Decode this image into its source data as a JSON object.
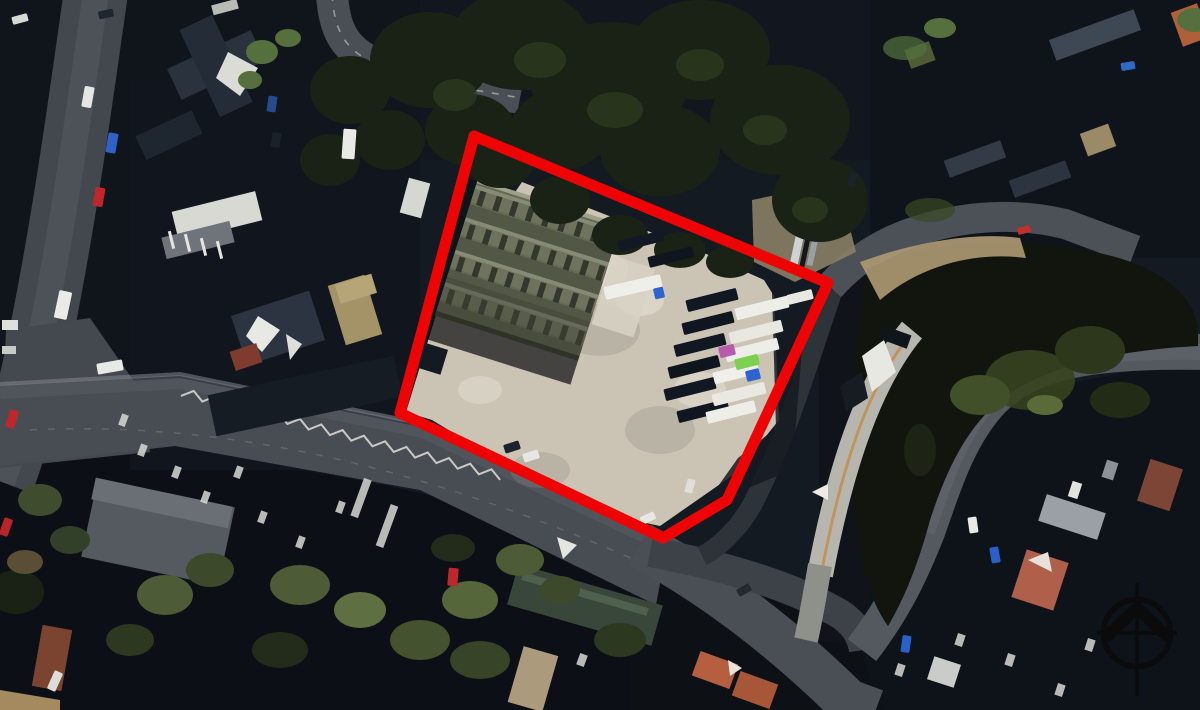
{
  "scene": {
    "description": "aerial-photograph of an industrial yard with warehouse and trailer park, red site boundary overlay, north compass icon"
  },
  "palette": {
    "boundary_red": "#ee0404",
    "compass_black": "#0b0b0b",
    "base_dark": "#141a21",
    "roof_dark": "#10151c",
    "road_grey": "#484d54",
    "concrete_light": "#cbc4b5",
    "warehouse_roof": "#666a56",
    "tree_dark": "#1a2215",
    "tree_olive": "#4e5c36",
    "water_dark": "#11150e",
    "earth_tan": "#ab9872",
    "terracotta": "#b65f40",
    "truck_white": "#eeeee8",
    "truck_dark": "#121822",
    "truck_magenta": "#b85aae",
    "truck_green": "#7cd24f",
    "truck_blue": "#2f63cf"
  },
  "site_boundary": {
    "color": "#ee0404",
    "stroke_width": 11,
    "points": "474,136 828,283 727,500 663,538 400,413"
  },
  "compass": {
    "transform": "translate(1137,633)",
    "color": "#0b0b0b"
  },
  "road_markings": {
    "zigzag": {
      "x1": 182,
      "y1": 392,
      "x2": 505,
      "y2": 477,
      "amplitude": 4,
      "step": 11
    }
  },
  "trailers": [
    {
      "x": 712,
      "y": 300,
      "w": 52,
      "h": 12,
      "rot": -14,
      "color": "#121822"
    },
    {
      "x": 708,
      "y": 323,
      "w": 52,
      "h": 12,
      "rot": -14,
      "color": "#10161f"
    },
    {
      "x": 700,
      "y": 345,
      "w": 52,
      "h": 12,
      "rot": -14,
      "color": "#121822"
    },
    {
      "x": 694,
      "y": 367,
      "w": 52,
      "h": 12,
      "rot": -14,
      "color": "#0f151d"
    },
    {
      "x": 690,
      "y": 389,
      "w": 52,
      "h": 12,
      "rot": -14,
      "color": "#121822"
    },
    {
      "x": 703,
      "y": 411,
      "w": 52,
      "h": 12,
      "rot": -14,
      "color": "#10161f"
    },
    {
      "x": 641,
      "y": 241,
      "w": 46,
      "h": 11,
      "rot": -14,
      "color": "#131924"
    },
    {
      "x": 671,
      "y": 257,
      "w": 46,
      "h": 11,
      "rot": -14,
      "color": "#101620"
    },
    {
      "x": 762,
      "y": 308,
      "w": 54,
      "h": 12,
      "rot": -14,
      "color": "#eeeee8"
    },
    {
      "x": 756,
      "y": 332,
      "w": 54,
      "h": 12,
      "rot": -14,
      "color": "#e8e7e0"
    },
    {
      "x": 752,
      "y": 350,
      "w": 54,
      "h": 12,
      "rot": -14,
      "color": "#eeeee8"
    },
    {
      "x": 736,
      "y": 373,
      "w": 46,
      "h": 12,
      "rot": -14,
      "color": "#f0efe9"
    },
    {
      "x": 739,
      "y": 394,
      "w": 54,
      "h": 12,
      "rot": -14,
      "color": "#e9e8e1"
    },
    {
      "x": 731,
      "y": 412,
      "w": 50,
      "h": 12,
      "rot": -14,
      "color": "#eeeee8"
    },
    {
      "x": 800,
      "y": 297,
      "w": 26,
      "h": 10,
      "rot": -14,
      "color": "#e9e9e3"
    },
    {
      "x": 727,
      "y": 351,
      "w": 16,
      "h": 11,
      "rot": -14,
      "color": "#b85aae"
    },
    {
      "x": 747,
      "y": 362,
      "w": 24,
      "h": 11,
      "rot": -14,
      "color": "#7cd24f"
    },
    {
      "x": 753,
      "y": 375,
      "w": 14,
      "h": 11,
      "rot": -14,
      "color": "#2f63cf"
    },
    {
      "x": 633,
      "y": 287,
      "w": 58,
      "h": 13,
      "rot": -13,
      "color": "#efefe9"
    },
    {
      "x": 659,
      "y": 293,
      "w": 10,
      "h": 11,
      "rot": -13,
      "color": "#2f63cf"
    }
  ],
  "vehicles": [
    {
      "x": 88,
      "y": 97,
      "w": 10,
      "h": 21,
      "rot": 10,
      "color": "#e6e6e2"
    },
    {
      "x": 112,
      "y": 143,
      "w": 10,
      "h": 20,
      "rot": 10,
      "color": "#2f62c8"
    },
    {
      "x": 99,
      "y": 197,
      "w": 10,
      "h": 19,
      "rot": 10,
      "color": "#c0272d"
    },
    {
      "x": 63,
      "y": 305,
      "w": 13,
      "h": 28,
      "rot": 12,
      "color": "#eaeae6"
    },
    {
      "x": 12,
      "y": 419,
      "w": 9,
      "h": 18,
      "rot": 16,
      "color": "#c0272d"
    },
    {
      "x": 6,
      "y": 527,
      "w": 9,
      "h": 18,
      "rot": 20,
      "color": "#b8242a"
    },
    {
      "x": 55,
      "y": 681,
      "w": 9,
      "h": 20,
      "rot": 24,
      "color": "#dcdcd8"
    },
    {
      "x": 20,
      "y": 19,
      "w": 16,
      "h": 8,
      "rot": -15,
      "color": "#d8d8d4"
    },
    {
      "x": 106,
      "y": 14,
      "w": 15,
      "h": 8,
      "rot": -12,
      "color": "#20262e"
    },
    {
      "x": 110,
      "y": 367,
      "w": 26,
      "h": 11,
      "rot": -10,
      "color": "#e8e8e4"
    },
    {
      "x": 349,
      "y": 144,
      "w": 13,
      "h": 30,
      "rot": 4,
      "color": "#e9e9e5"
    },
    {
      "x": 272,
      "y": 104,
      "w": 9,
      "h": 16,
      "rot": 8,
      "color": "#274a8c"
    },
    {
      "x": 276,
      "y": 140,
      "w": 9,
      "h": 15,
      "rot": 8,
      "color": "#1a2129"
    },
    {
      "x": 512,
      "y": 447,
      "w": 16,
      "h": 9,
      "rot": -18,
      "color": "#1c232e"
    },
    {
      "x": 531,
      "y": 456,
      "w": 16,
      "h": 9,
      "rot": -18,
      "color": "#e6e6e2"
    },
    {
      "x": 648,
      "y": 518,
      "w": 15,
      "h": 8,
      "rot": -25,
      "color": "#e8e8e4"
    },
    {
      "x": 744,
      "y": 590,
      "w": 14,
      "h": 8,
      "rot": -30,
      "color": "#23292f"
    },
    {
      "x": 690,
      "y": 486,
      "w": 8,
      "h": 14,
      "rot": 15,
      "color": "#dfe0da"
    },
    {
      "x": 973,
      "y": 525,
      "w": 9,
      "h": 16,
      "rot": -8,
      "color": "#e8e8e6"
    },
    {
      "x": 995,
      "y": 555,
      "w": 9,
      "h": 16,
      "rot": -10,
      "color": "#2862c8"
    },
    {
      "x": 906,
      "y": 644,
      "w": 9,
      "h": 17,
      "rot": 8,
      "color": "#2862c8"
    },
    {
      "x": 1128,
      "y": 66,
      "w": 14,
      "h": 8,
      "rot": -10,
      "color": "#2f6ac9"
    },
    {
      "x": 1024,
      "y": 230,
      "w": 13,
      "h": 7,
      "rot": -15,
      "color": "#c23028"
    },
    {
      "x": 852,
      "y": 180,
      "w": 8,
      "h": 14,
      "rot": 15,
      "color": "#1c222b"
    },
    {
      "x": 453,
      "y": 577,
      "w": 10,
      "h": 18,
      "rot": 5,
      "color": "#c0272d"
    }
  ]
}
